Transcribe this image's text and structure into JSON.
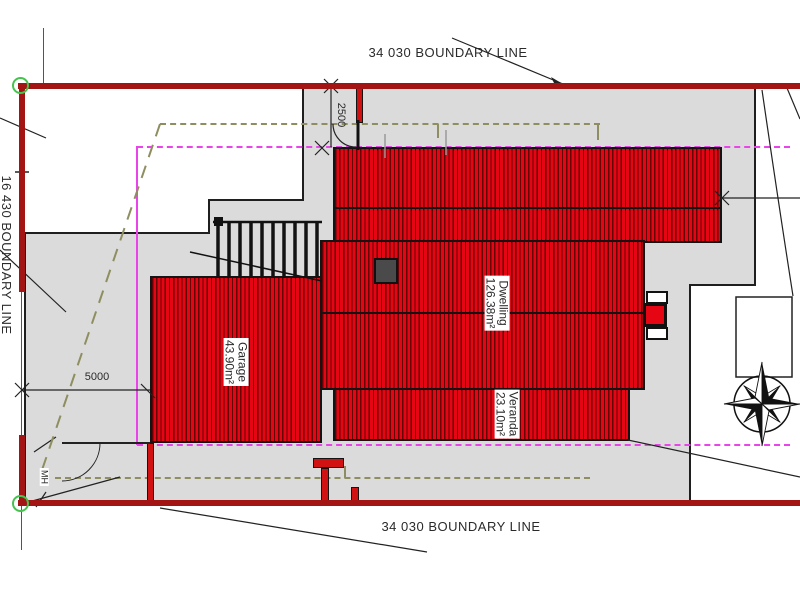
{
  "plan": {
    "boundaries": {
      "top_label": "34 030 BOUNDARY LINE",
      "bottom_label": "34 030 BOUNDARY LINE",
      "left_label": "16 430 BOUNDARY LINE"
    },
    "dimensions": {
      "front_offset": "2500",
      "side_offset": "5000"
    },
    "markers": {
      "manhole": "MH"
    },
    "buildings": {
      "garage": {
        "name": "Garage",
        "area": "43.90m²"
      },
      "dwelling": {
        "name": "Dwelling",
        "area": "126.38m²"
      },
      "veranda": {
        "name": "Veranda",
        "area": "23.10m²"
      }
    },
    "colors": {
      "site_fill": "#dbdbdb",
      "building_fill": "#e60613",
      "boundary_line": "#a31515",
      "setback_line": "#e944e9",
      "easement_line": "#8e8e60",
      "survey_marker": "#46c24f"
    }
  }
}
